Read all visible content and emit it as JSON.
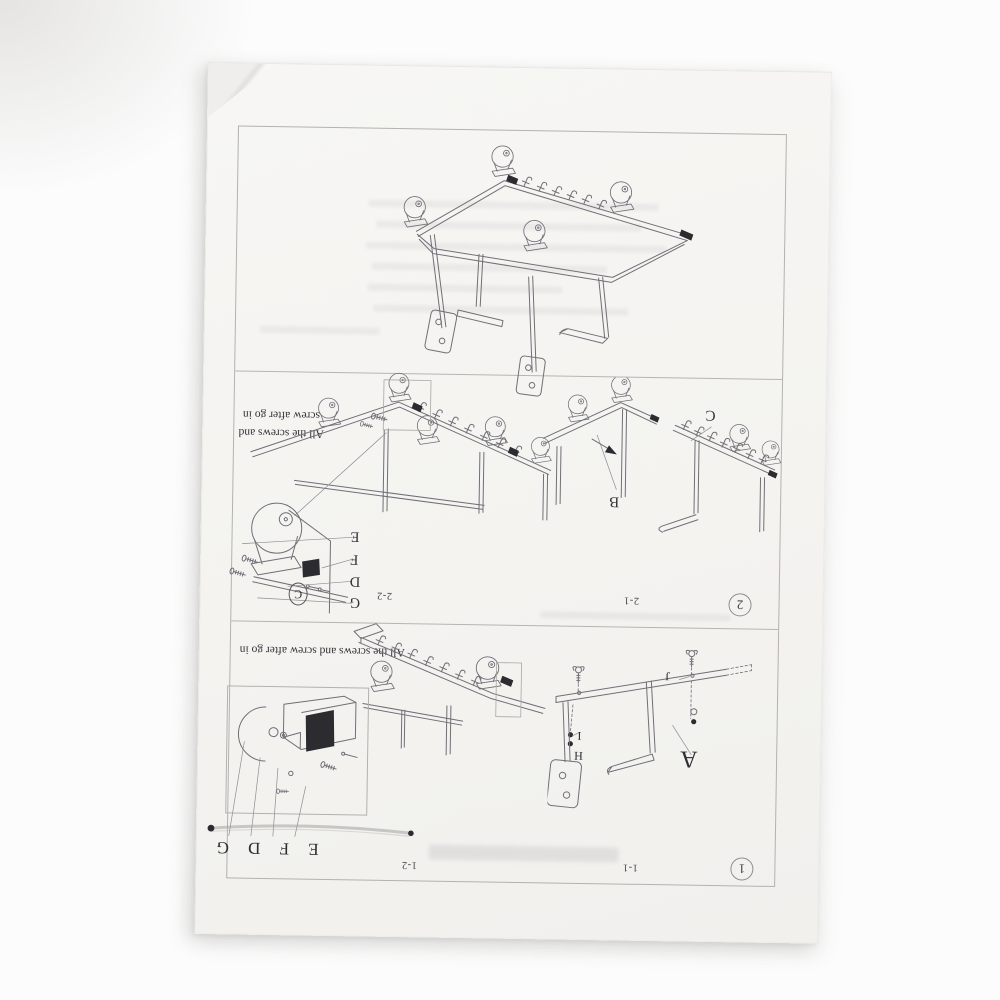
{
  "colors": {
    "paper": "#f6f5f2",
    "line_art": "#6f6f77",
    "ink": "#2f2f35",
    "frame_border": "#b5b2ad"
  },
  "manual": {
    "step2": {
      "badge": "2",
      "note_line1": "All the screws and",
      "note_line2": "screw after go in",
      "sub_left": {
        "caption": "2-2",
        "detail_circle_label": "C",
        "detail_labels": [
          "E",
          "F",
          "D",
          "G"
        ]
      },
      "sub_right": {
        "caption": "2-1",
        "label_b": "B",
        "label_c": "C"
      }
    },
    "step1": {
      "badge": "1",
      "note": "All the screws and screw after go in",
      "sub_left": {
        "caption": "1-2",
        "detail_labels": [
          "E",
          "F",
          "D",
          "G"
        ]
      },
      "sub_right": {
        "caption": "1-1",
        "label_a": "A",
        "label_h": "H",
        "label_i": "I",
        "label_j": "J"
      }
    }
  }
}
